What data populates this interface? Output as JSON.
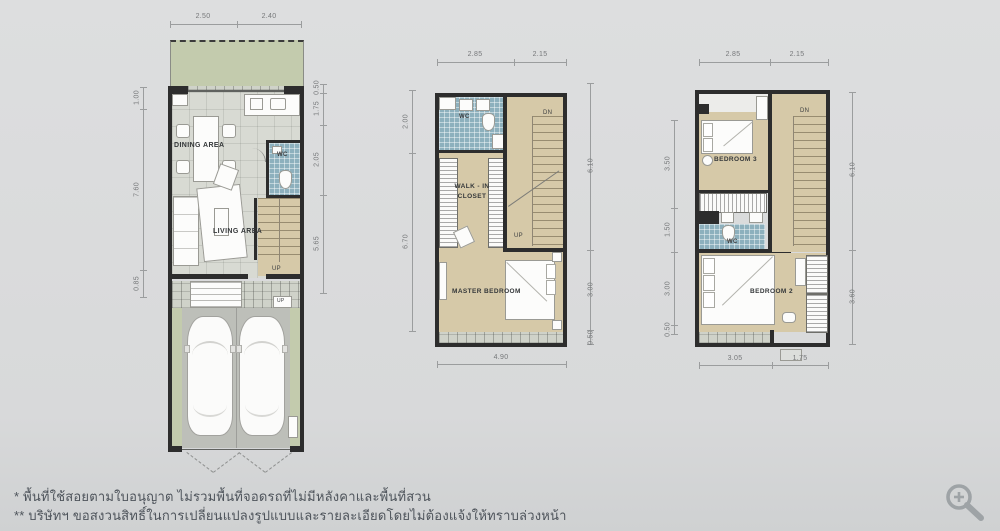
{
  "meta": {
    "sheet_type": "townhouse-floorplans",
    "background": "#d8d9da"
  },
  "colors": {
    "wall": "#2d2d2d",
    "terrace_green": "#c3cbad",
    "floor_tile_gray": "#d8dad3",
    "floor_wood_tan": "#d6c9a8",
    "wc_blue_tile": "#8db0bd",
    "garage_floor": "#bdbfb9",
    "dimension_line": "#9b9d9e",
    "note_text": "#4e545b"
  },
  "floor1": {
    "labels": {
      "dining": "DINING AREA",
      "living": "LIVING AREA",
      "wc": "WC",
      "stairs_up": "UP",
      "entry_up": "UP"
    },
    "dims": {
      "top": [
        "2.50",
        "2.40"
      ],
      "left": [
        "1.00",
        "7.60",
        "0.85"
      ],
      "right": [
        "0.50",
        "1.75",
        "2.05",
        "5.65"
      ]
    }
  },
  "floor2": {
    "labels": {
      "wc": "WC",
      "closet": "WALK - IN CLOSET",
      "master": "MASTER BEDROOM",
      "stairs_dn": "DN",
      "stairs_up": "UP"
    },
    "dims": {
      "top": [
        "2.85",
        "2.15"
      ],
      "left": [
        "2.00",
        "6.70"
      ],
      "right": [
        "6.10",
        "3.00",
        "0.50"
      ],
      "bottom": [
        "4.90"
      ]
    }
  },
  "floor3": {
    "labels": {
      "bedroom3": "BEDROOM 3",
      "wc": "WC",
      "bedroom2": "BEDROOM 2",
      "stairs_dn": "DN"
    },
    "dims": {
      "top": [
        "2.85",
        "2.15"
      ],
      "left": [
        "3.50",
        "1.50",
        "3.00",
        "0.50"
      ],
      "right": [
        "6.10",
        "3.60"
      ],
      "bottom": [
        "3.05",
        "1.75"
      ]
    }
  },
  "footnotes": {
    "line1": "* พื้นที่ใช้สอยตามใบอนุญาต ไม่รวมพื้นที่จอดรถที่ไม่มีหลังคาและพื้นที่สวน",
    "line2": "** บริษัทฯ ขอสงวนสิทธิ์ในการเปลี่ยนแปลงรูปแบบและรายละเอียดโดยไม่ต้องแจ้งให้ทราบล่วงหน้า"
  },
  "controls": {
    "zoom_icon": "zoom-in-magnifier"
  }
}
